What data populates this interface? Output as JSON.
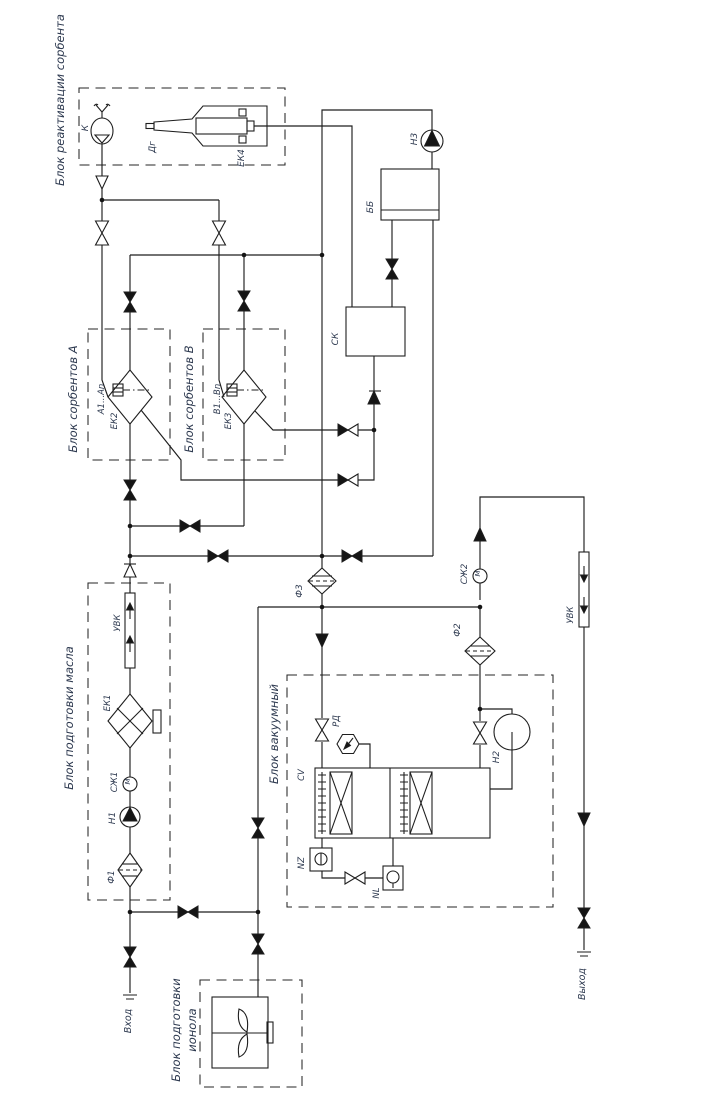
{
  "block_labels": {
    "reactivation": "Блок реактивации сорбента",
    "sorbent_a": "Блок сорбентов А",
    "sorbent_b": "Блок сорбентов В",
    "oil_prep": "Блок подготовки масла",
    "vacuum": "Блок вакуумный",
    "ionol_line1": "Блок подготовки",
    "ionol_line2": "ионола"
  },
  "equipment_tags": {
    "k": "К",
    "dg": "Дг",
    "ek4": "ЕК4",
    "n3": "Н3",
    "bb": "ББ",
    "sk": "СК",
    "ek2": "ЕК2",
    "ek2_cartridges": "А1...Аn",
    "ek3": "ЕК3",
    "ek3_cartridges": "В1...Вn",
    "f3": "Ф3",
    "f2": "Ф2",
    "f1": "Ф1",
    "ek1": "ЕК1",
    "szh1": "СЖ1",
    "szh2": "СЖ2",
    "uvk_oil": "УВК",
    "uvk_out": "УВК",
    "n1": "Н1",
    "n2": "Н2",
    "rd": "РД",
    "cv": "CV",
    "nz": "NZ",
    "nl": "NL",
    "motor_mark": "М"
  },
  "ports": {
    "inlet": "Вход",
    "outlet": "Выход"
  },
  "colors": {
    "line": "#1e1e1e",
    "text": "#2e3a50",
    "background": "#ffffff"
  }
}
